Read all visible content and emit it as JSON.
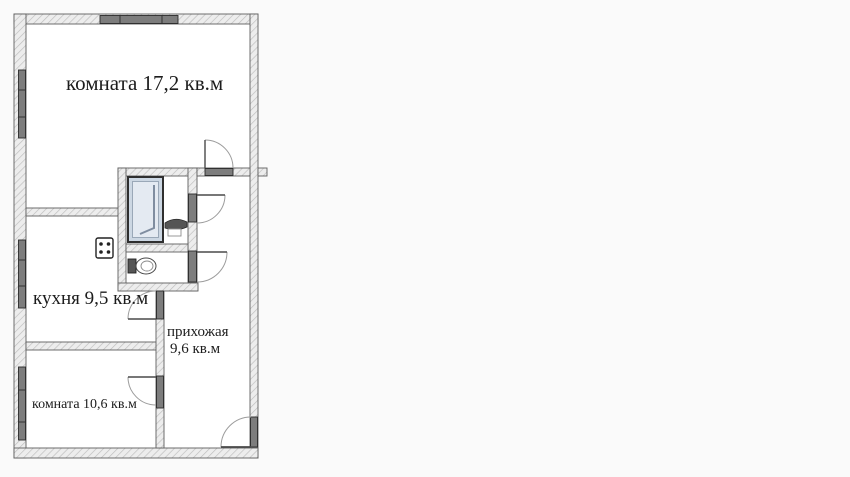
{
  "document": {
    "kind": "apartment-floor-plan",
    "background_color": "#fafafa"
  },
  "colors": {
    "floor": "#ffffff",
    "wall_fill": "#ededed",
    "hatch_line": "#bdbdbd",
    "wall_outline": "#5f5f5f",
    "opening_fill": "#7d7d7d",
    "opening_outline": "#2a2a2a",
    "door_arc": "#9c9c9c",
    "door_leaf": "#4a4a4a",
    "bathtub_fill": "#ccd7e3",
    "bathtub_inner": "#e4eaf2",
    "fixture_dark": "#555555",
    "text": "#1c1c1c"
  },
  "rooms": {
    "living": {
      "name": "комната",
      "area_sqm": "17,2",
      "label": "комната 17,2 кв.м"
    },
    "kitchen": {
      "name": "кухня",
      "area_sqm": "9,5",
      "label": "кухня 9,5 кв.м"
    },
    "hallway": {
      "name": "прихожая",
      "area_sqm": "9,6",
      "label_line1": "прихожая",
      "label_line2": "9,6 кв.м"
    },
    "small_room": {
      "name": "комната",
      "area_sqm": "10,6",
      "label": "комната 10,6 кв.м"
    }
  },
  "fixtures": {
    "bathtub": "bathtub",
    "sink": "sink",
    "toilet": "toilet",
    "stove": "stove-4-burner"
  },
  "features": {
    "windows": [
      "top-wall-window",
      "left-wall-window-living",
      "left-wall-window-kitchen",
      "left-wall-window-small-room"
    ],
    "doors": [
      "living-room-door",
      "bathroom-door",
      "wc-door",
      "kitchen-door",
      "small-room-door",
      "entrance-door"
    ]
  }
}
